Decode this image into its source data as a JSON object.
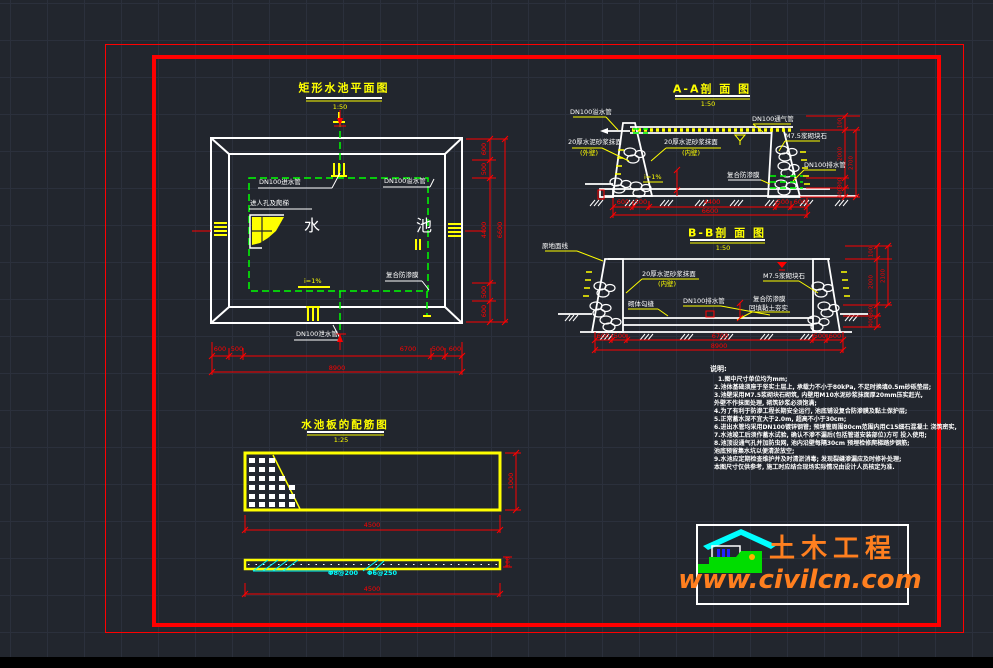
{
  "plan": {
    "title": "矩形水池平面图",
    "scale": "1:50",
    "pool_word_1": "水",
    "pool_word_2": "池",
    "label_inlet": "DN100进水管",
    "label_overflow": "DN100溢水管",
    "label_drain": "DN100泄水管",
    "label_manhole": "进人孔及爬梯",
    "label_membrane": "复合防渗膜",
    "label_slope": "i=1%",
    "dims_bottom": [
      "600",
      "500",
      "6700",
      "500",
      "600"
    ],
    "dim_bottom_total": "8900",
    "dims_right": [
      "600",
      "500",
      "4400",
      "500",
      "600"
    ],
    "dim_right_total": "6600"
  },
  "section_aa": {
    "title": "A-A剖 面 图",
    "scale": "1:50",
    "label_overflow": "DN100溢水管",
    "label_plaster_out": "20厚水泥砂浆抹面",
    "label_plaster_out_sub": "(外壁)",
    "label_plaster_in": "20厚水泥砂浆抹面",
    "label_plaster_in_sub": "(内壁)",
    "label_vent": "DN100通气管",
    "label_stone": "M7.5浆砌块石",
    "label_drain": "DN100排水管",
    "label_membrane": "复合防渗膜",
    "label_slope": "i=1%",
    "dims_bottom": [
      "600",
      "500",
      "4400",
      "500",
      "600"
    ],
    "dim_bottom_total": "6600",
    "dims_right": [
      "100",
      "2000",
      "300",
      "400"
    ],
    "dim_right_total": "2700"
  },
  "section_bb": {
    "title": "B-B剖 面 图",
    "scale": "1:50",
    "label_ground": "原地面线",
    "label_plaster": "20厚水泥砂浆抹面",
    "label_plaster_sub": "(内壁)",
    "label_joint": "砌体勾缝",
    "label_drain": "DN100排水管",
    "label_stone": "M7.5浆砌块石",
    "label_membrane": "复合防渗膜",
    "label_membrane_sub": "回填黏土夯实",
    "dims_bottom": [
      "600",
      "500",
      "6700",
      "500",
      "600"
    ],
    "dim_bottom_total": "8900",
    "dims_right": [
      "100",
      "2000",
      "300",
      "400"
    ],
    "dim_right_total": "2100"
  },
  "rebar": {
    "title": "水池板的配筋图",
    "scale": "1:25",
    "dim_height": "1000",
    "dim_width_top": "4500",
    "dim_width_bottom": "4500",
    "thickness": "100",
    "bar_main": "Φ8@200",
    "bar_dist": "Φ6@250"
  },
  "notes": {
    "title": "说明:",
    "lines": [
      "1.图中尺寸单位均为mm;",
      "2.池体基础须座于坚实土层上, 承载力不小于80kPa, 不足时换填0.5m砂砾垫层;",
      "3.池壁采用M7.5浆砌块石砌筑, 内壁用M10水泥砂浆抹面厚20mm压实赶光,",
      "  外壁不作抹面处理, 砌筑砂浆必须饱满;",
      "4.为了有利于防渗工程长期安全运行, 池底铺设复合防渗膜及黏土保护层;",
      "5.正常蓄水深不宜大于2.0m, 超高不小于30cm;",
      "6.进出水管均采用DN100镀锌钢管; 预埋管周围80cm范围内用C15细石混凝土 浇筑密实,",
      "7.水池竣工后须作蓄水试验, 确认不渗不漏后(包括管道安装部位)方可 投入使用;",
      "8.池顶设通气孔并加防虫网, 池内沿壁每隔30cm 预埋检修爬梯踏步钢筋;",
      "  池底预留集水坑以便清淤放空;",
      "9.水池应定期检查维护并及时清淤消毒; 发现裂缝渗漏应及时修补处理;",
      "  本图尺寸仅供参考, 施工时应结合现场实际情况由设计人员核定为准."
    ]
  },
  "logo": {
    "brand": "土木工程",
    "site": "www.civilcn.com"
  },
  "colors": {
    "background": "#22262e",
    "line_white": "#ffffff",
    "accent_red": "#ff0000",
    "accent_yellow": "#ffff00",
    "accent_green": "#00ff00",
    "accent_cyan": "#00ffff",
    "logo_orange": "#ff7f1f"
  }
}
